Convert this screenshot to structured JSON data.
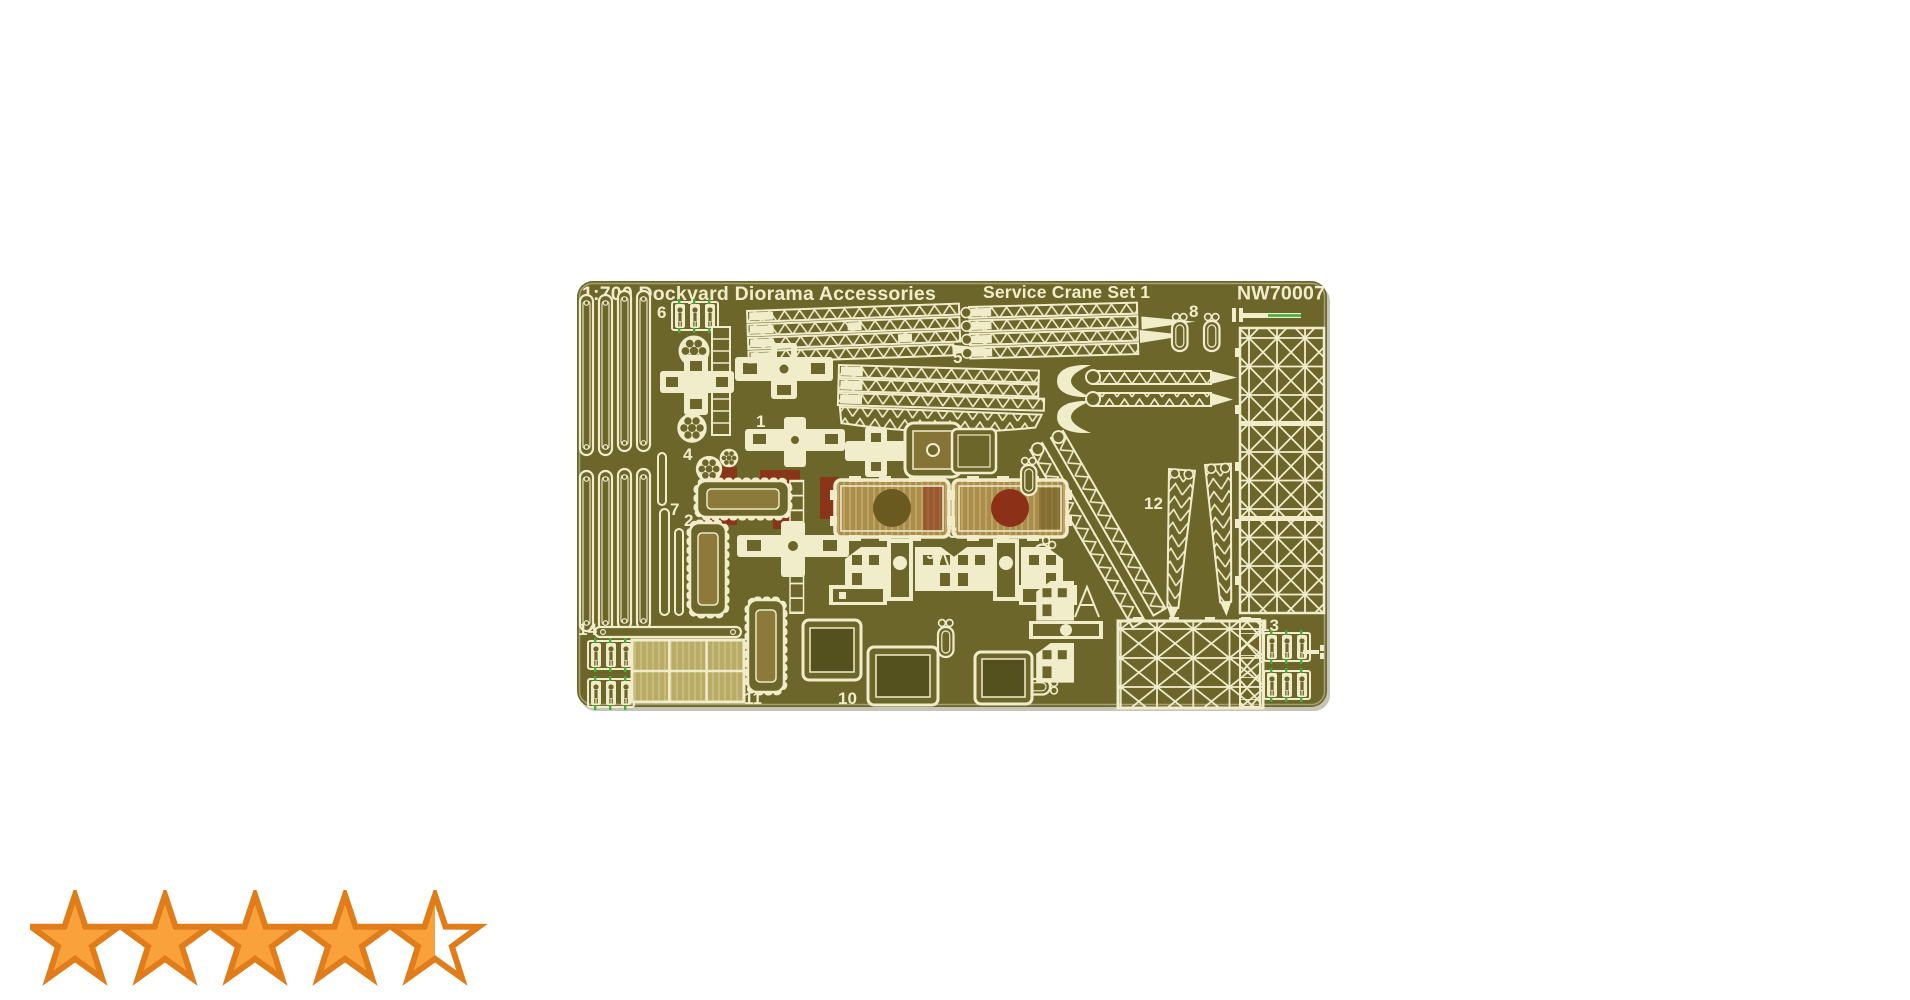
{
  "plate": {
    "title_left": "1:700 Dockyard Diorama Accessories",
    "title_center": "Service Crane Set 1",
    "part_code": "NW70007",
    "part_labels": [
      {
        "text": "1"
      },
      {
        "text": "2"
      },
      {
        "text": "3"
      },
      {
        "text": "4"
      },
      {
        "text": "5"
      },
      {
        "text": "6"
      },
      {
        "text": "7"
      },
      {
        "text": "8"
      },
      {
        "text": "9"
      },
      {
        "text": "10"
      },
      {
        "text": "11"
      },
      {
        "text": "12"
      },
      {
        "text": "13"
      },
      {
        "text": "14"
      }
    ]
  },
  "rating": {
    "stars": 4.5,
    "max_stars": 5
  },
  "colors": {
    "page_bg": "#ffffff",
    "plate_base": "#6c662b",
    "etch": "#f1ecca",
    "tan": "#ab8d4a",
    "tan_light": "#b9ac66",
    "brown": "#6b5a20",
    "maroon": "#8c3018",
    "green": "#3fae3c",
    "dark_inner": "#55511f",
    "star_fill": "#f9a23c",
    "star_stroke": "#e07d1a"
  }
}
